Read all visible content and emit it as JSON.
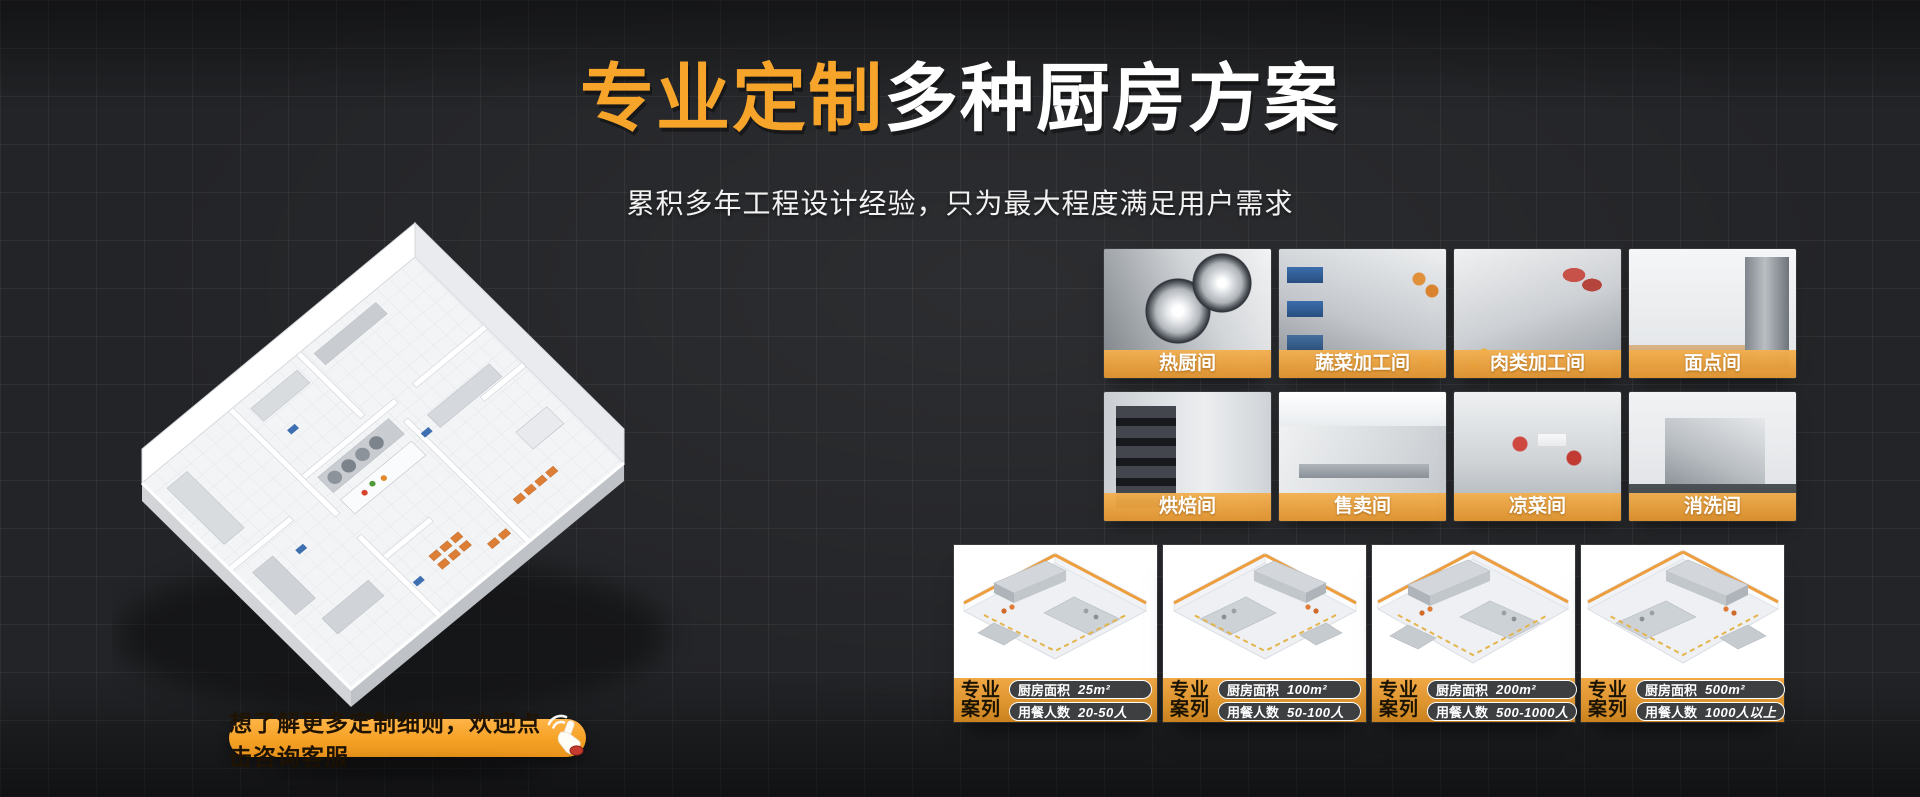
{
  "header": {
    "title_highlight": "专业定制",
    "title_rest": "多种厨房方案",
    "subtitle": "累积多年工程设计经验，只为最大程度满足用户需求"
  },
  "cta": {
    "label": "想了解更多定制细则，欢迎点击咨询客服",
    "icon": "click-hand-icon"
  },
  "rooms": [
    {
      "label": "热厨间"
    },
    {
      "label": "蔬菜加工间"
    },
    {
      "label": "肉类加工间"
    },
    {
      "label": "面点间"
    },
    {
      "label": "烘焙间"
    },
    {
      "label": "售卖间"
    },
    {
      "label": "凉菜间"
    },
    {
      "label": "消洗间"
    }
  ],
  "cases": [
    {
      "tag_line1": "专业",
      "tag_line2": "案列",
      "area_label": "厨房面积",
      "area_value": "25m²",
      "diners_label": "用餐人数",
      "diners_value": "20-50人"
    },
    {
      "tag_line1": "专业",
      "tag_line2": "案列",
      "area_label": "厨房面积",
      "area_value": "100m²",
      "diners_label": "用餐人数",
      "diners_value": "50-100人"
    },
    {
      "tag_line1": "专业",
      "tag_line2": "案列",
      "area_label": "厨房面积",
      "area_value": "200m²",
      "diners_label": "用餐人数",
      "diners_value": "500-1000人"
    },
    {
      "tag_line1": "专业",
      "tag_line2": "案列",
      "area_label": "厨房面积",
      "area_value": "500m²",
      "diners_label": "用餐人数",
      "diners_value": "1000人以上"
    }
  ],
  "colors": {
    "accent_orange": "#F6A42A",
    "banner_orange": "#E59A3C",
    "case_bar_orange": "#DE9530",
    "background": "#232427",
    "pill_dark": "#3D3F41"
  }
}
